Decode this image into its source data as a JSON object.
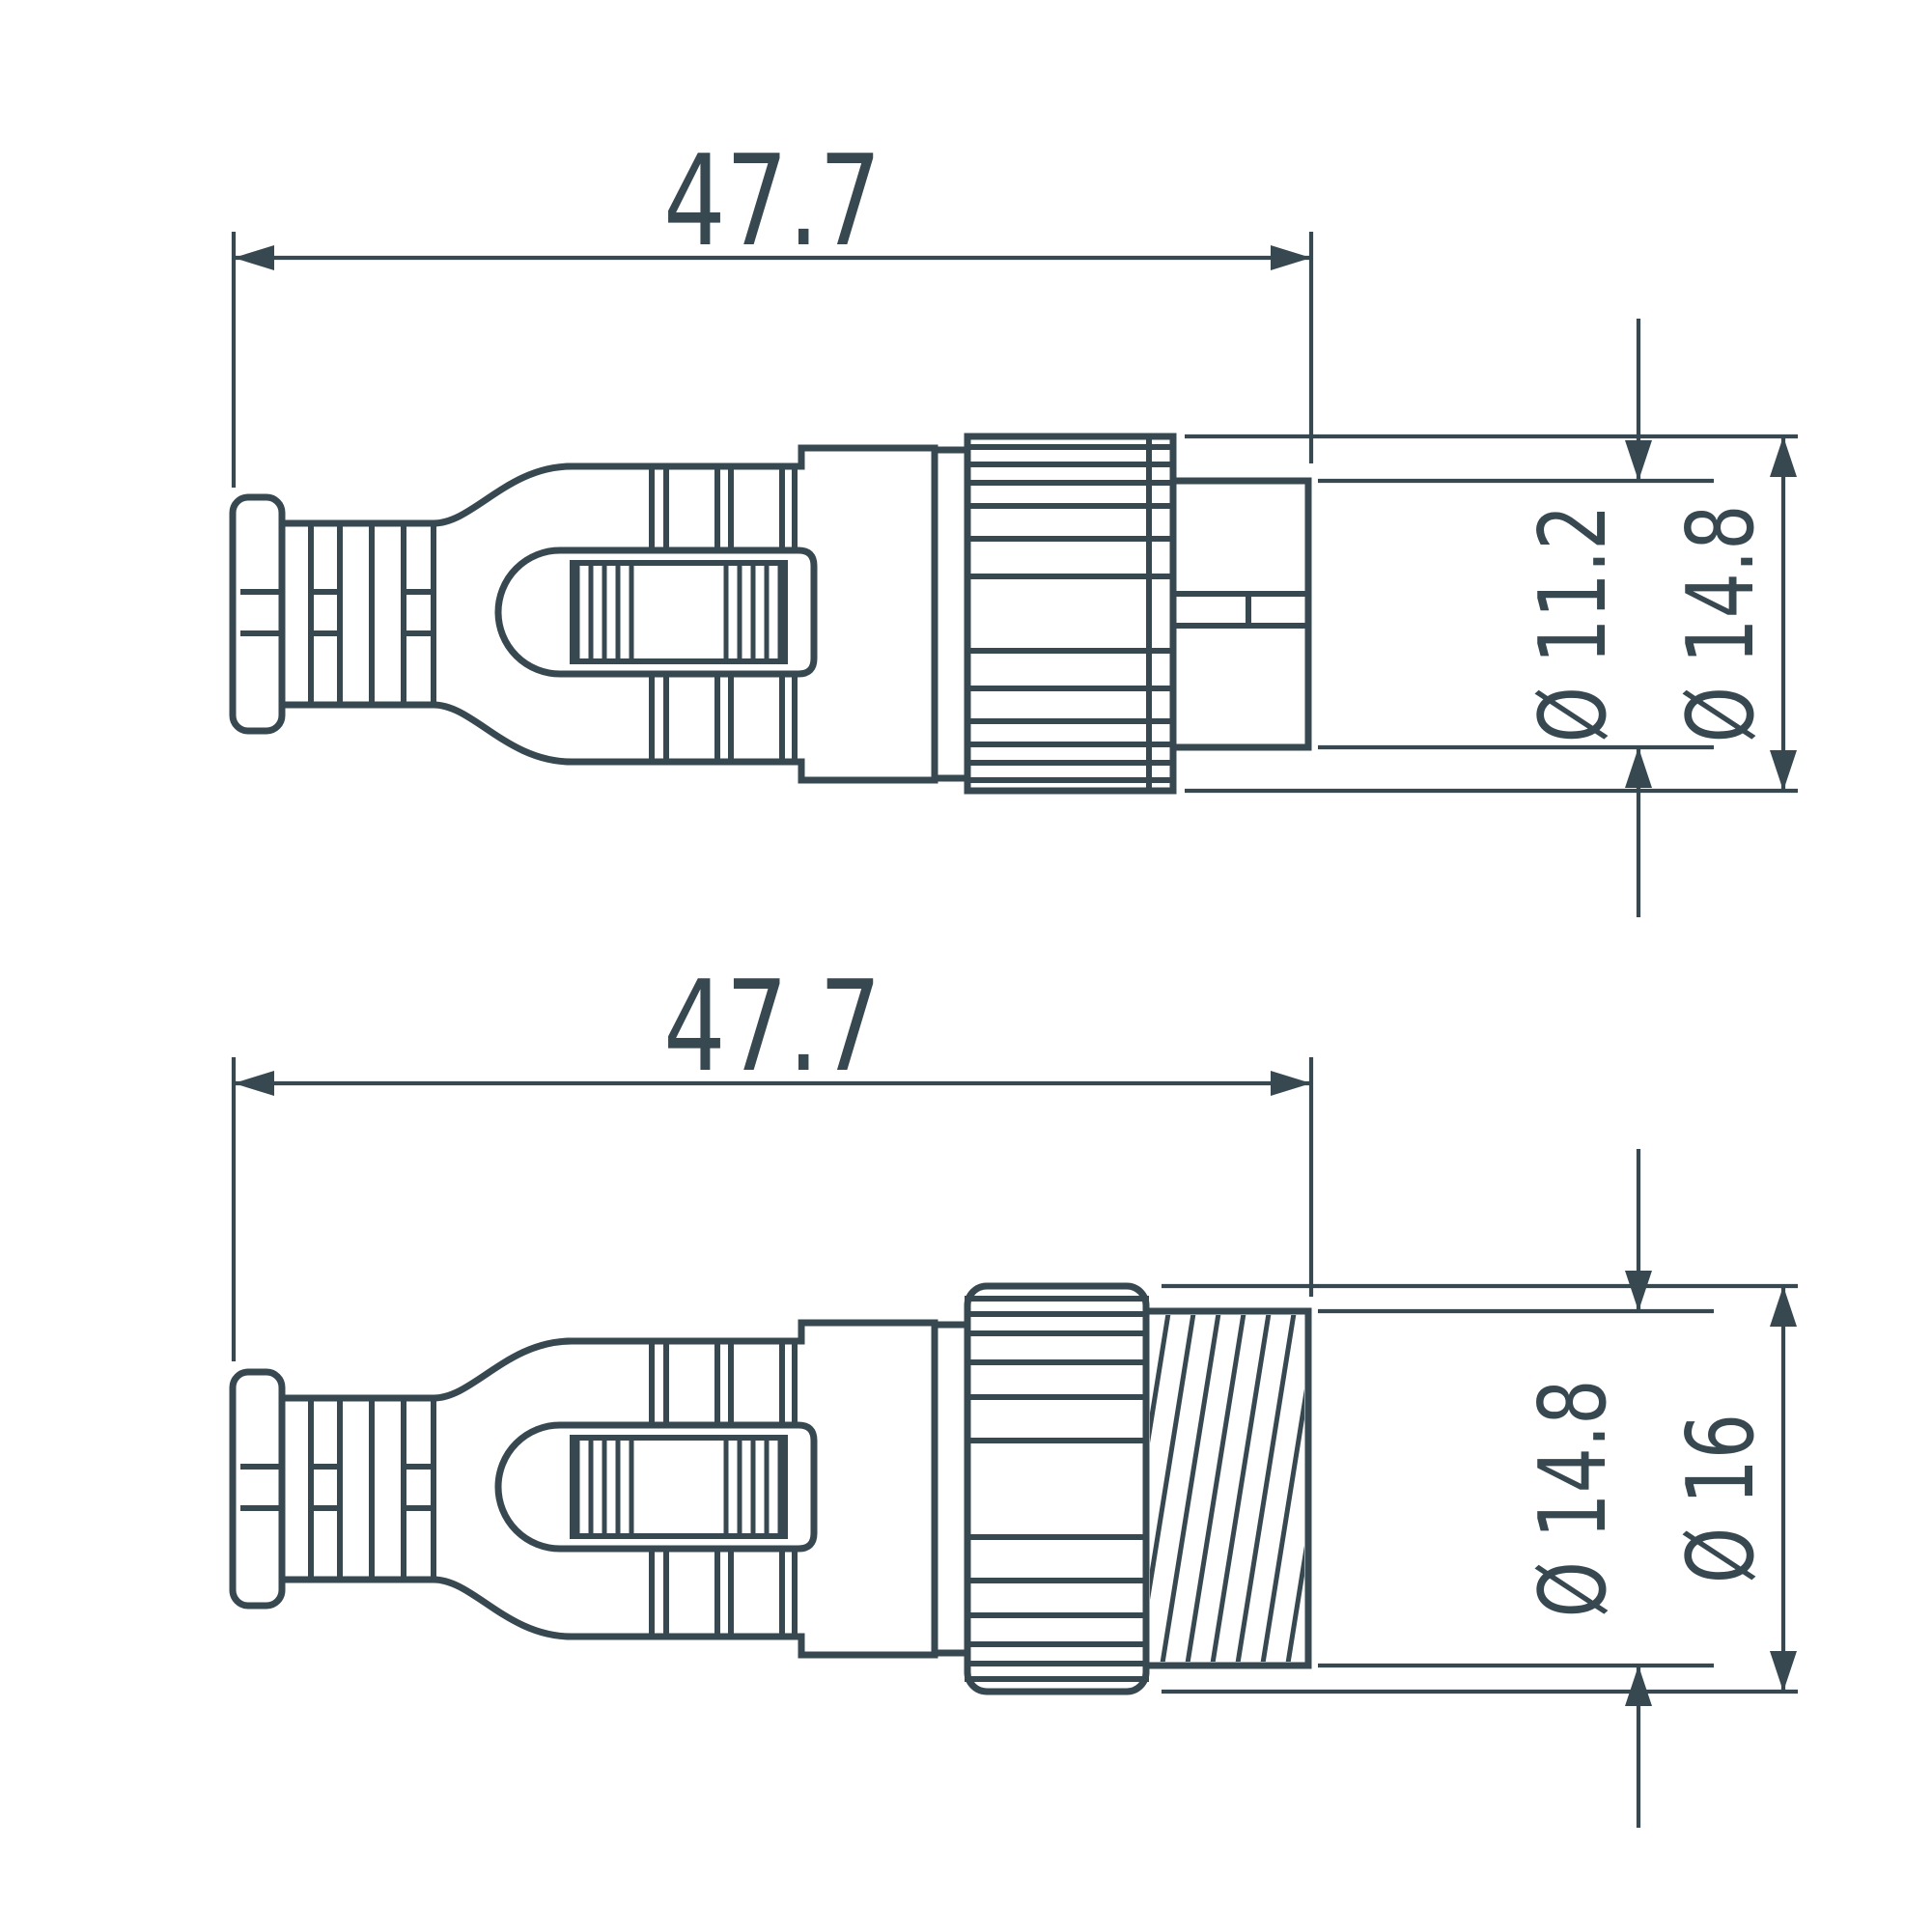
{
  "drawing": {
    "title": "connector-dimension-drawing",
    "line_color": "#374850",
    "background": "#ffffff",
    "views": [
      {
        "name": "male-connector-side-view",
        "overall_length": "47.7",
        "diameters": [
          {
            "label": "Ø 11.2",
            "feature": "plug-tip"
          },
          {
            "label": "Ø 14.8",
            "feature": "coupling-nut"
          }
        ]
      },
      {
        "name": "female-connector-side-view",
        "overall_length": "47.7",
        "diameters": [
          {
            "label": "Ø 14.8",
            "feature": "threaded-coupling"
          },
          {
            "label": "Ø 16",
            "feature": "coupling-nut"
          }
        ]
      }
    ]
  }
}
